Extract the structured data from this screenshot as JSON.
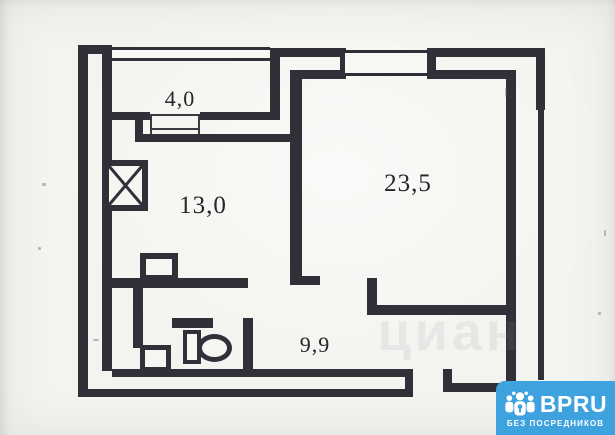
{
  "floorplan": {
    "rooms": [
      {
        "name": "balcony-hall",
        "area": "4,0"
      },
      {
        "name": "left-room",
        "area": "13,0"
      },
      {
        "name": "living-room",
        "area": "23,5"
      },
      {
        "name": "kitchen-corridor",
        "area": "9,9"
      }
    ],
    "fixtures": [
      "shaft-x-icon",
      "stove-icon",
      "sink-icon",
      "toilet-icon"
    ],
    "wall_color": "#2f3038",
    "paper_color": "#f3f3ef",
    "watermark_text": "циан"
  },
  "badge": {
    "brand": "BPRU",
    "tagline": "БЕЗ ПОСРЕДНИКОВ",
    "background": "#3ea2df",
    "icon": "people-group-icon"
  }
}
